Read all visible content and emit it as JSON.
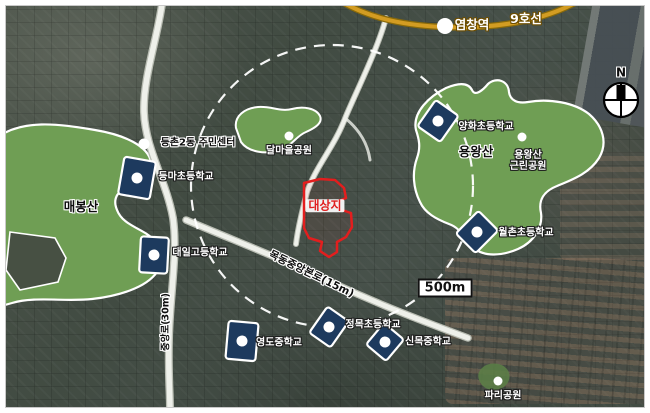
{
  "subway": {
    "station": "염창역",
    "line": "9호선"
  },
  "compass": {
    "north": "N"
  },
  "scale": {
    "label": "500m"
  },
  "site": {
    "label": "대상지"
  },
  "roads": {
    "vertical": "중앙로(30m)",
    "diagonal": "목동중앙본로(15m)"
  },
  "parks": {
    "maebongsan": "매봉산",
    "dalmaeul": "달마을공원",
    "yongwangsan": "용왕산",
    "yongwangsan_park_line1": "용왕산",
    "yongwangsan_park_line2": "근린공원",
    "paris": "파리공원"
  },
  "places": {
    "community_center": "등촌2동 주민센터"
  },
  "schools": {
    "deungma": "등마초등학교",
    "daeil": "대일고등학교",
    "yanghwa": "양화초등학교",
    "wolchon": "월촌초등학교",
    "yeongdo": "영도중학교",
    "jeongmok": "정목초등학교",
    "sinmok": "신목중학교"
  },
  "colors": {
    "metro_line": "#c9971a",
    "park_green": "#6f9e54",
    "school_marker": "#1d3a5e",
    "site_outline": "#e31e1e",
    "road": "#eef0ea",
    "circle_dash": "#ffffff"
  }
}
